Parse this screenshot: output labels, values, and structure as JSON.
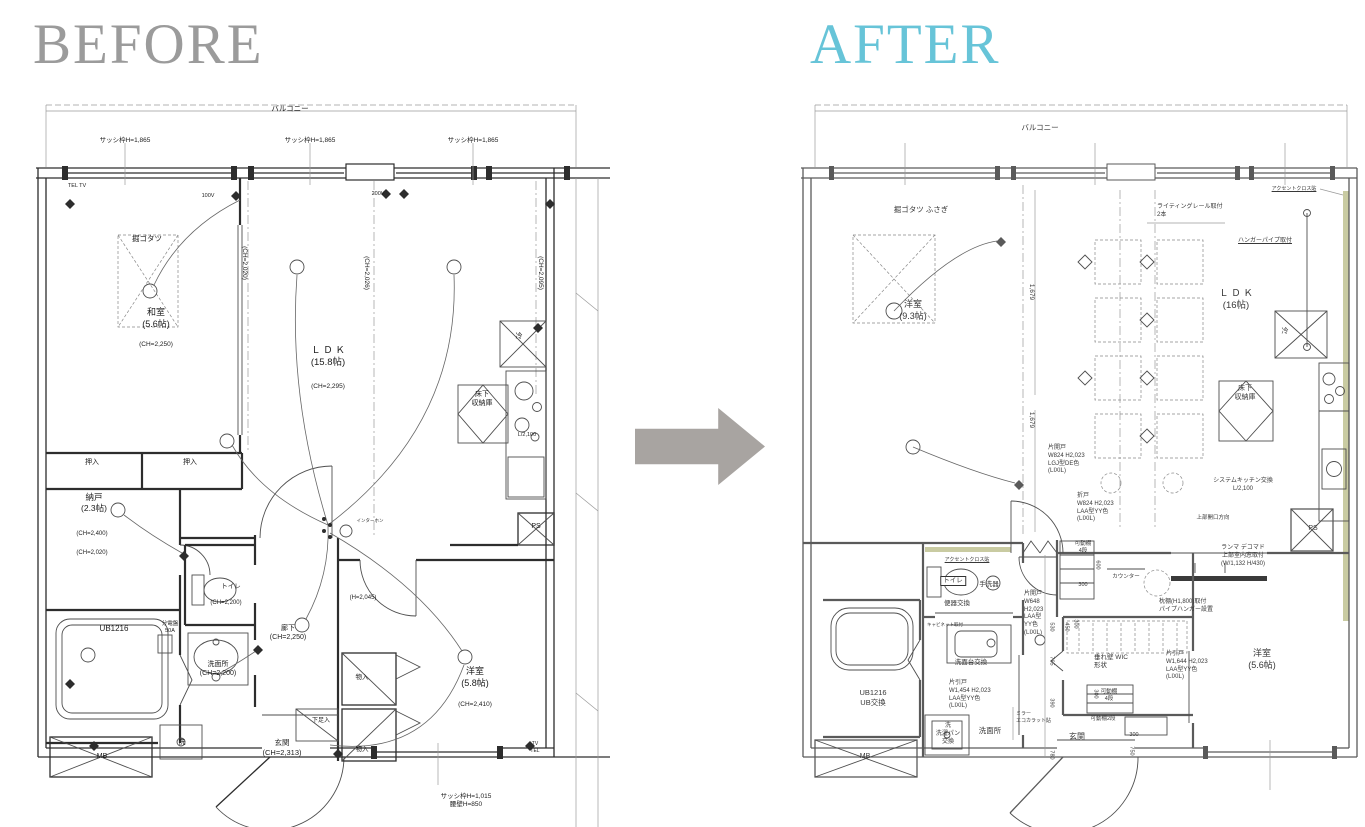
{
  "titles": {
    "before": "BEFORE",
    "after": "AFTER"
  },
  "colors": {
    "before_title": "#9b9b9b",
    "after_title": "#67c4d8",
    "arrow": "#a8a4a1",
    "accent_wall": "#c9cba2",
    "line_before": "#2d2d2d",
    "line_after": "#5a5a5a"
  },
  "arrow": {
    "direction": "right"
  },
  "before_plan": {
    "labels": [
      {
        "t": "バルコニー",
        "x": 260,
        "y": 9,
        "s": 7.5,
        "n": "balcony-label"
      },
      {
        "t": "サッシ枠H=1,865",
        "x": 95,
        "y": 42,
        "s": 6.5
      },
      {
        "t": "サッシ枠H=1,865",
        "x": 280,
        "y": 42,
        "s": 6.5
      },
      {
        "t": "サッシ枠H=1,865",
        "x": 443,
        "y": 42,
        "s": 6.5
      },
      {
        "t": "TEL TV",
        "x": 47,
        "y": 88,
        "s": 5.5
      },
      {
        "t": "100V",
        "x": 178,
        "y": 98,
        "s": 5.5
      },
      {
        "t": "200V",
        "x": 348,
        "y": 96,
        "s": 5.5
      },
      {
        "t": "掘ゴタツ",
        "x": 117,
        "y": 139,
        "s": 7.5
      },
      {
        "t": "和室\n(5.6帖)",
        "x": 126,
        "y": 212,
        "s": 9,
        "n": "room-washitsu-label"
      },
      {
        "t": "(CH=2,250)",
        "x": 126,
        "y": 246,
        "s": 6.5
      },
      {
        "t": "(CH=2,020)",
        "x": 214,
        "y": 168,
        "s": 6.5,
        "v": 1
      },
      {
        "t": "(CH=2,026)",
        "x": 336,
        "y": 178,
        "s": 6.5,
        "v": 1
      },
      {
        "t": "(CH=2,095)",
        "x": 510,
        "y": 178,
        "s": 6.5,
        "v": 1
      },
      {
        "t": "Ｌ Ｄ Ｋ\n(15.8帖)",
        "x": 298,
        "y": 250,
        "s": 9.5,
        "n": "room-ldk-label"
      },
      {
        "t": "(CH=2,295)",
        "x": 298,
        "y": 288,
        "s": 6.5
      },
      {
        "t": "冷",
        "x": 489,
        "y": 237,
        "s": 7
      },
      {
        "t": "床下\n収納庫",
        "x": 452,
        "y": 295,
        "s": 7
      },
      {
        "t": "L/2,100",
        "x": 497,
        "y": 337,
        "s": 5.5
      },
      {
        "t": "PS",
        "x": 506,
        "y": 427,
        "s": 7
      },
      {
        "t": "押入",
        "x": 62,
        "y": 363,
        "s": 7
      },
      {
        "t": "押入",
        "x": 160,
        "y": 363,
        "s": 7
      },
      {
        "t": "納戸\n(2.3帖)",
        "x": 64,
        "y": 397,
        "s": 8.5,
        "n": "room-nando-label"
      },
      {
        "t": "(CH=2,400)",
        "x": 62,
        "y": 436,
        "s": 6
      },
      {
        "t": "(CH=2,020)",
        "x": 62,
        "y": 455,
        "s": 6
      },
      {
        "t": "トイレ",
        "x": 201,
        "y": 488,
        "s": 6.5
      },
      {
        "t": "(CH=2,200)",
        "x": 196,
        "y": 505,
        "s": 6
      },
      {
        "t": "UB1216",
        "x": 84,
        "y": 529,
        "s": 8,
        "n": "room-ub-label"
      },
      {
        "t": "分電盤\n50A",
        "x": 140,
        "y": 526,
        "s": 5.5
      },
      {
        "t": "洗面所\n(CH=2,200)",
        "x": 188,
        "y": 565,
        "s": 7,
        "n": "room-senmenjo-label"
      },
      {
        "t": "廊下\n(CH=2,250)",
        "x": 258,
        "y": 529,
        "s": 7,
        "n": "room-rouka-label"
      },
      {
        "t": "(H=2,045)",
        "x": 333,
        "y": 500,
        "s": 6
      },
      {
        "t": "インターホン",
        "x": 340,
        "y": 423,
        "s": 4.5
      },
      {
        "t": "玄関\n(CH=2,313)",
        "x": 252,
        "y": 643,
        "s": 7.5,
        "n": "room-genkan-label"
      },
      {
        "t": "下足入",
        "x": 291,
        "y": 623,
        "s": 6
      },
      {
        "t": "物入",
        "x": 332,
        "y": 579,
        "s": 6.5
      },
      {
        "t": "物入",
        "x": 332,
        "y": 651,
        "s": 6.5
      },
      {
        "t": "洗",
        "x": 152,
        "y": 643,
        "s": 7
      },
      {
        "t": "MB",
        "x": 72,
        "y": 657,
        "s": 7
      },
      {
        "t": "洋室\n(5.8帖)",
        "x": 445,
        "y": 571,
        "s": 9,
        "n": "room-yoshitsu-label"
      },
      {
        "t": "(CH=2,410)",
        "x": 445,
        "y": 606,
        "s": 6.5
      },
      {
        "t": "サッシ枠H=1,015\n腰壁H=850",
        "x": 436,
        "y": 698,
        "s": 6.5
      },
      {
        "t": "TV\nTEL",
        "x": 505,
        "y": 646,
        "s": 5
      }
    ]
  },
  "after_plan": {
    "labels": [
      {
        "t": "バルコニー",
        "x": 245,
        "y": 28,
        "s": 7.5,
        "n": "balcony-label"
      },
      {
        "t": "アクセントクロス貼",
        "x": 499,
        "y": 91,
        "s": 5,
        "u": 1
      },
      {
        "t": "掘ゴタツ ふさぎ",
        "x": 126,
        "y": 110,
        "s": 7.5
      },
      {
        "t": "洋室\n(9.3帖)",
        "x": 118,
        "y": 204,
        "s": 9,
        "n": "room-yoshitsu93-label"
      },
      {
        "t": "ライティングレール取付\n2本",
        "x": 362,
        "y": 109,
        "s": 6,
        "a": "l"
      },
      {
        "t": "ハンガーパイプ取付",
        "x": 470,
        "y": 143,
        "s": 6,
        "u": 1
      },
      {
        "t": "Ｌ Ｄ Ｋ\n(16帖)",
        "x": 441,
        "y": 193,
        "s": 9.5,
        "n": "room-ldk-label"
      },
      {
        "t": "冷",
        "x": 490,
        "y": 232,
        "s": 7
      },
      {
        "t": "床下\n収納庫",
        "x": 450,
        "y": 289,
        "s": 7
      },
      {
        "t": "システムキッチン交換\nL/2,100",
        "x": 448,
        "y": 383,
        "s": 6
      },
      {
        "t": "上部開口方向",
        "x": 418,
        "y": 420,
        "s": 5.5
      },
      {
        "t": "PS",
        "x": 518,
        "y": 429,
        "s": 7
      },
      {
        "t": "ランマ デコマド\n上部室内窓取付\n(W/1,132 H/430)",
        "x": 448,
        "y": 450,
        "s": 6
      },
      {
        "t": "1,679",
        "x": 236,
        "y": 197,
        "s": 6.5,
        "v": 1
      },
      {
        "t": "1,679",
        "x": 236,
        "y": 325,
        "s": 6.5,
        "v": 1
      },
      {
        "t": "片開戸\nW824 H2,023\nLGJ型DE色\n(LIXIL)",
        "x": 253,
        "y": 350,
        "s": 6,
        "a": "l"
      },
      {
        "t": "折戸\nW824 H2,023\nLAA型YY色\n(LIXIL)",
        "x": 282,
        "y": 398,
        "s": 6,
        "a": "l"
      },
      {
        "t": "可動棚\n4段",
        "x": 288,
        "y": 446,
        "s": 5.5
      },
      {
        "t": "600",
        "x": 302,
        "y": 470,
        "s": 5.5,
        "v": 1
      },
      {
        "t": "300",
        "x": 288,
        "y": 487,
        "s": 5.5
      },
      {
        "t": "カウンター",
        "x": 331,
        "y": 479,
        "s": 5.5
      },
      {
        "t": "アクセントクロス貼",
        "x": 172,
        "y": 462,
        "s": 5,
        "u": 1
      },
      {
        "t": "トイレ",
        "x": 158,
        "y": 481,
        "s": 6.5,
        "b": 1
      },
      {
        "t": "手洗器",
        "x": 194,
        "y": 486,
        "s": 6.5
      },
      {
        "t": "便器交換",
        "x": 162,
        "y": 505,
        "s": 6.5
      },
      {
        "t": "片開戸\nW648\nH2,023\nLAA型\nYY色\n(LIXIL)",
        "x": 229,
        "y": 496,
        "s": 6,
        "a": "l"
      },
      {
        "t": "530",
        "x": 256,
        "y": 532,
        "s": 5.5,
        "v": 1
      },
      {
        "t": "765",
        "x": 256,
        "y": 566,
        "s": 5.5,
        "v": 1
      },
      {
        "t": "390",
        "x": 256,
        "y": 608,
        "s": 5.5,
        "v": 1
      },
      {
        "t": "780",
        "x": 256,
        "y": 660,
        "s": 5.5,
        "v": 1
      },
      {
        "t": "450",
        "x": 271,
        "y": 532,
        "s": 5.5,
        "v": 1
      },
      {
        "t": "300",
        "x": 280,
        "y": 529,
        "s": 5.5,
        "v": 1
      },
      {
        "t": "枕棚(H1,800)取付\nパイプハンガー設置",
        "x": 364,
        "y": 504,
        "s": 6,
        "a": "l"
      },
      {
        "t": "垂れ壁 WIC\n形状",
        "x": 299,
        "y": 559,
        "s": 6.5,
        "a": "l"
      },
      {
        "t": "洗面台交換",
        "x": 176,
        "y": 564,
        "s": 6.5
      },
      {
        "t": "片引戸\nW1,454 H2,023\nLAA型YY色\n(LIXIL)",
        "x": 154,
        "y": 585,
        "s": 6,
        "a": "l"
      },
      {
        "t": "UB1216\nUB交換",
        "x": 78,
        "y": 593,
        "s": 7.5,
        "n": "room-ub-label"
      },
      {
        "t": "洗\n洗濯パン\n交換",
        "x": 153,
        "y": 628,
        "s": 6
      },
      {
        "t": "洗面所",
        "x": 195,
        "y": 631,
        "s": 7.5,
        "n": "room-senmenjo-label"
      },
      {
        "t": "ミラー\nエコカラット貼",
        "x": 221,
        "y": 616,
        "s": 5,
        "a": "l"
      },
      {
        "t": "キャビネット取付",
        "x": 150,
        "y": 527,
        "s": 4.5
      },
      {
        "t": "MB",
        "x": 70,
        "y": 657,
        "s": 7
      },
      {
        "t": "玄関",
        "x": 282,
        "y": 637,
        "s": 8,
        "n": "room-genkan-label"
      },
      {
        "t": "可動棚2段",
        "x": 308,
        "y": 621,
        "s": 5.5
      },
      {
        "t": "300",
        "x": 339,
        "y": 637,
        "s": 5.5
      },
      {
        "t": "750",
        "x": 336,
        "y": 656,
        "s": 5.5,
        "v": 1
      },
      {
        "t": "可動棚\n4段",
        "x": 314,
        "y": 594,
        "s": 5.5
      },
      {
        "t": "300",
        "x": 300,
        "y": 599,
        "s": 5.5,
        "v": 1
      },
      {
        "t": "片引戸\nW1,644 H2,023\nLAA型YY色\n(LIXIL)",
        "x": 371,
        "y": 556,
        "s": 6,
        "a": "l"
      },
      {
        "t": "洋室\n(5.6帖)",
        "x": 467,
        "y": 553,
        "s": 9,
        "n": "room-yoshitsu56-label"
      }
    ]
  }
}
